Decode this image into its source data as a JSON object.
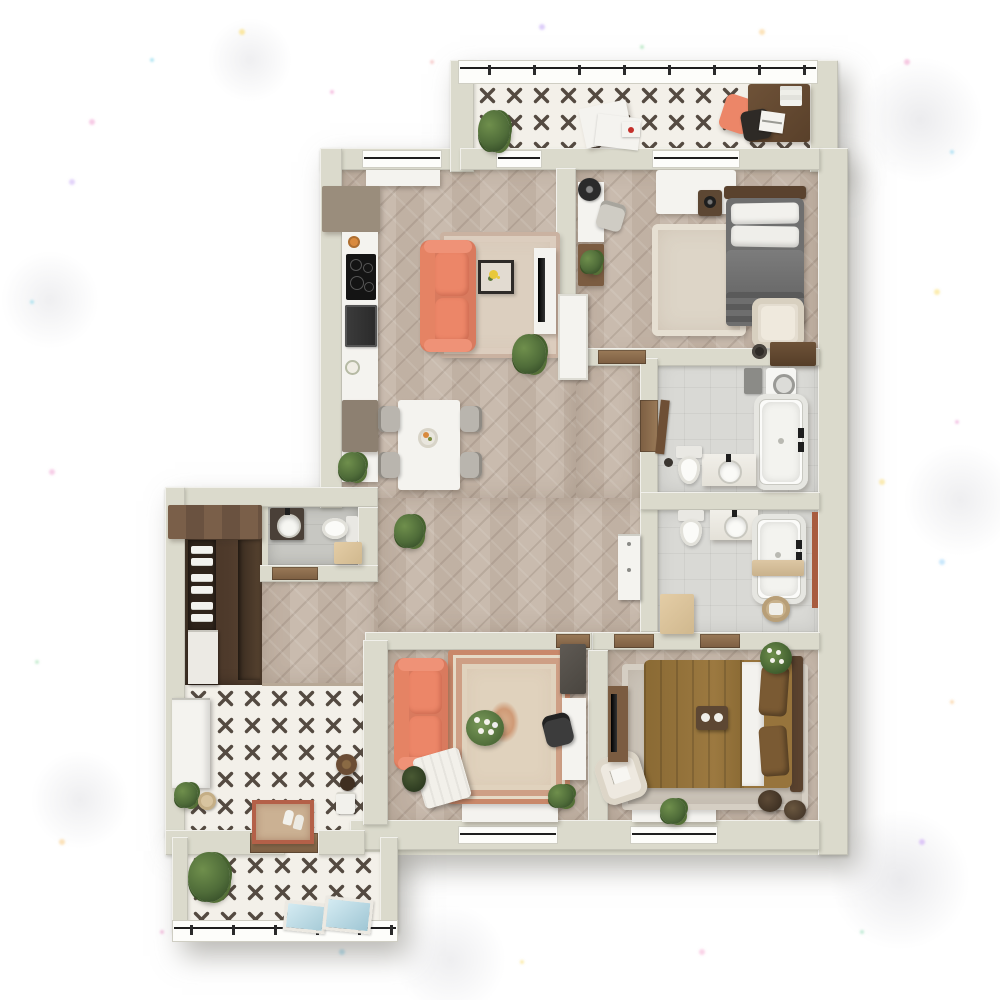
{
  "scene": {
    "description": "3D top-down rendering of an apartment floor plan",
    "view": "top-down",
    "render_style": "architectural 3D visualization, no text labels"
  },
  "palette": {
    "wall": "#dbdacc",
    "wallShade": "#c6c5b4",
    "wood": "#c6b7a9",
    "woodLine": "#8a7363",
    "bathFloor": "#d9d9d5",
    "wcFloor": "#c7c7c2",
    "closetFloor": "#4e3a2b",
    "tileBg": "#f3f0e9",
    "tileX": "#544a41",
    "coral": "#ec8668",
    "coralDark": "#d97a5e",
    "rugBeige": "#dccfbf",
    "rugField": "#e0d2bd",
    "rustAccent": "#c9886a",
    "bedGray": "#6f6f6f",
    "bedCamel": "#97743c",
    "headboard": "#5a422e",
    "darkWood": "#6e5238",
    "lightWood": "#d9c09a",
    "white": "#f4f3ef",
    "black": "#1e1e1e",
    "plantGreen": "#4f6c39",
    "plantDark": "#2f4624",
    "glassBlue": "#c2e1ec",
    "doormat": "#b46048"
  },
  "rooms": [
    {
      "name": "terrace",
      "floor": "patterned-tile",
      "items": [
        "potted-plant",
        "magazines",
        "note-card",
        "lounge-chair",
        "writing-desk",
        "desk-chair",
        "laptop",
        "book-stack",
        "glass-railing"
      ]
    },
    {
      "name": "kitchen-living-room",
      "floor": "herringbone-wood",
      "items": [
        "upper-cabinets",
        "kitchen-counter",
        "cooktop",
        "oven",
        "base-cabinet",
        "coral-sofa",
        "coffee-table",
        "area-rug",
        "tv-stand",
        "tv",
        "dining-table",
        "dining-chairs-x4",
        "fruit-bowl",
        "potted-plants"
      ]
    },
    {
      "name": "bedroom-1",
      "floor": "herringbone-wood",
      "items": [
        "double-bed-gray",
        "pillows",
        "headboard",
        "nightstand",
        "area-rug",
        "armchair",
        "desk",
        "desk-chair",
        "table-fan",
        "shelf-unit",
        "built-in-wardrobe",
        "radiator-cabinet"
      ]
    },
    {
      "name": "bathroom-1",
      "floor": "ceramic-tile",
      "items": [
        "bathtub",
        "vanity-sink",
        "toilet",
        "washing-machine",
        "wood-counter",
        "vessel-sink",
        "door-panel"
      ]
    },
    {
      "name": "bathroom-2",
      "floor": "ceramic-tile",
      "items": [
        "bathtub",
        "bath-caddy",
        "vanity-sink",
        "toilet",
        "laundry-basket",
        "storage-cabinet"
      ]
    },
    {
      "name": "bedroom-2",
      "floor": "herringbone-wood",
      "items": [
        "double-bed-camel",
        "pillows",
        "headboard",
        "breakfast-tray",
        "flower-plant",
        "area-rug",
        "lounge-chair-white",
        "desk",
        "tv",
        "poufs",
        "window-sill-plant"
      ]
    },
    {
      "name": "living-room-2",
      "floor": "herringbone-wood",
      "items": [
        "coral-sofa",
        "oriental-rug",
        "flower-bouquet",
        "side-table-white",
        "office-desk",
        "office-chair",
        "tall-cabinet",
        "potted-plants"
      ]
    },
    {
      "name": "hallway",
      "floor": "herringbone-wood",
      "items": [
        "shelf-cabinet-white",
        "potted-plant"
      ]
    },
    {
      "name": "wc",
      "floor": "stone-tile",
      "items": [
        "vanity-sink",
        "toilet",
        "storage-box"
      ]
    },
    {
      "name": "walk-in-closet",
      "floor": "dark-wood",
      "items": [
        "wardrobe-top",
        "wardrobe-shelves",
        "folded-linens",
        "drawer-unit"
      ]
    },
    {
      "name": "entry-hall",
      "floor": "patterned-tile",
      "items": [
        "shoe-cabinet",
        "potted-plant",
        "storage-basket",
        "doormat",
        "shoes",
        "coat-stand",
        "hat",
        "towel-stack",
        "entry-door-threshold"
      ]
    },
    {
      "name": "balcony",
      "floor": "patterned-tile",
      "items": [
        "potted-plant",
        "glass-floor-panels",
        "glass-railing"
      ]
    }
  ]
}
